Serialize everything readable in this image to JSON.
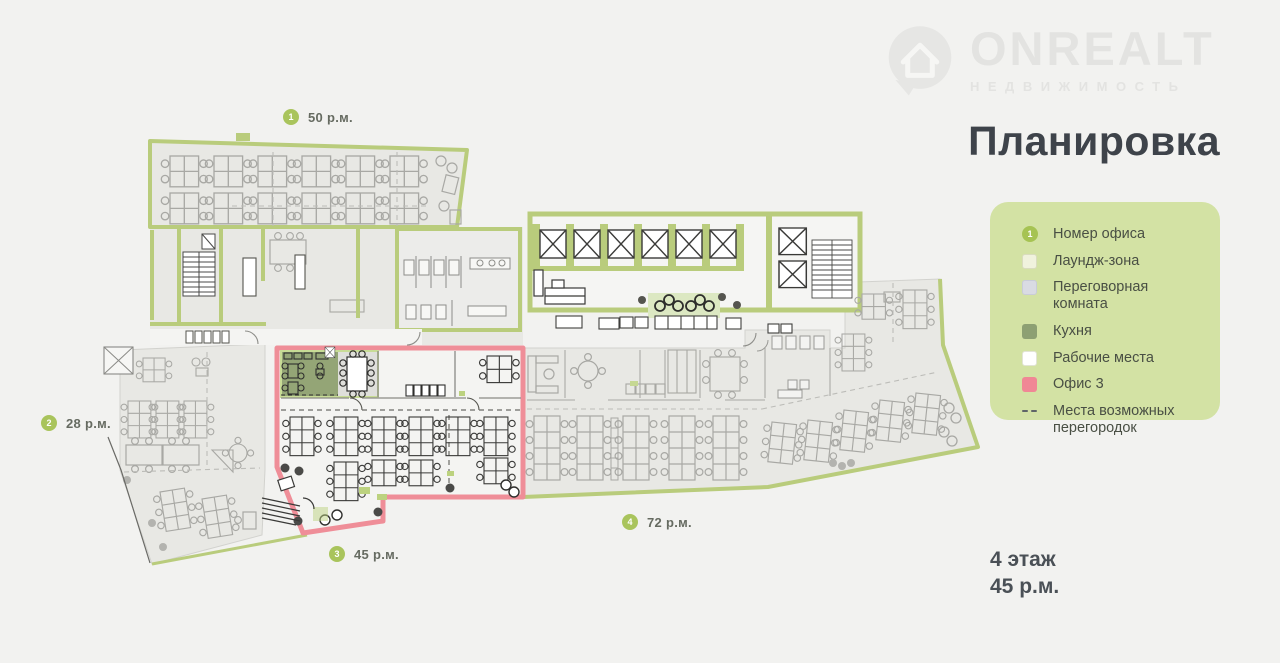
{
  "logo": {
    "name": "ONREALT",
    "subtitle": "НЕДВИЖИМОСТЬ"
  },
  "title": "Планировка",
  "legend": {
    "items": [
      {
        "swatch": "office-number",
        "number": "1",
        "label": "Номер офиса"
      },
      {
        "swatch": "lounge",
        "label": "Лаундж-зона"
      },
      {
        "swatch": "meeting",
        "label": "Переговорная комната"
      },
      {
        "swatch": "kitchen",
        "label": "Кухня"
      },
      {
        "swatch": "workplaces",
        "label": "Рабочие места"
      },
      {
        "swatch": "office3",
        "label": "Офис 3"
      },
      {
        "swatch": "partitions",
        "label": "Места возможных перегородок"
      }
    ]
  },
  "plan": {
    "offices": [
      {
        "number": "1",
        "area": "50 р.м."
      },
      {
        "number": "2",
        "area": "28 р.м."
      },
      {
        "number": "3",
        "area": "45 р.м."
      },
      {
        "number": "4",
        "area": "72 р.м."
      }
    ]
  },
  "floor_info": {
    "floor": "4 этаж",
    "area": "45 р.м."
  },
  "colors": {
    "background": "#f2f2f0",
    "legend_panel": "#d3e2a4",
    "accent_green": "#a9c45c",
    "wall_green": "#b9cc7c",
    "office3_pink": "#ef8e98",
    "kitchen": "#94a576",
    "floor_gray": "#e8e8e4",
    "title_text": "#3e434a"
  }
}
